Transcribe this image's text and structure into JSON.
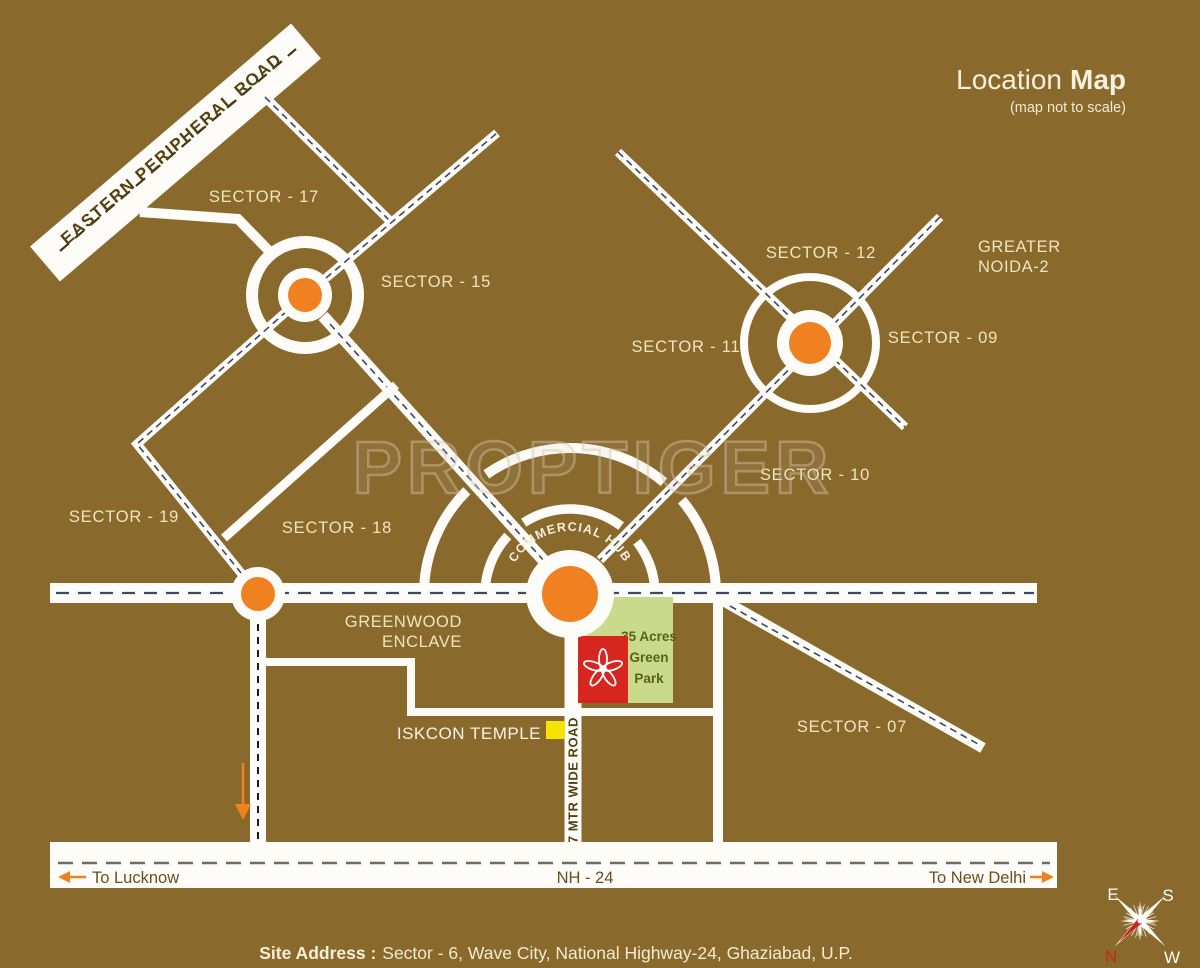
{
  "title": {
    "main": "Location",
    "main_bold": "Map",
    "subtitle": "(map not to scale)"
  },
  "watermark": "PROPTIGER",
  "labels": {
    "sector_17": "SECTOR - 17",
    "sector_15": "SECTOR - 15",
    "sector_12": "SECTOR - 12",
    "sector_11": "SECTOR - 11",
    "sector_09": "SECTOR - 09",
    "sector_10": "SECTOR - 10",
    "sector_19": "SECTOR - 19",
    "sector_18": "SECTOR - 18",
    "sector_07": "SECTOR - 07",
    "greater_noida_line1": "GREATER",
    "greater_noida_line2": "NOIDA-2",
    "greenwood_line1": "GREENWOOD",
    "greenwood_line2": "ENCLAVE",
    "commercial_hub": "COMMERCIAL HUB",
    "iskcon_temple": "ISKCON TEMPLE",
    "green_park_line1": "35 Acres",
    "green_park_line2": "Green",
    "green_park_line3": "Park"
  },
  "roads": {
    "eastern_peripheral_road": "EASTERN PERIPHERAL ROAD",
    "wide_road": "57 MTR WIDE ROAD",
    "nh24": "NH - 24",
    "to_lucknow": "To Lucknow",
    "to_new_delhi": "To New Delhi"
  },
  "footer": {
    "site_address_label": "Site Address :",
    "site_address_text": "Sector - 6, Wave City, National Highway-24, Ghaziabad, U.P."
  },
  "compass": {
    "east": "E",
    "south": "S",
    "north": "N",
    "west": "W"
  },
  "colors": {
    "background": "#8a692d",
    "road_white": "#fdfcf8",
    "accent_orange": "#ef8120",
    "sector_text": "#f0e4bd",
    "dark_road_text": "#55400f",
    "red_marker": "#d6261f",
    "green_park": "#c9da8c",
    "green_park_text": "#5a611c",
    "yellow_marker": "#f6e300",
    "dash_navy": "#3b4a63",
    "compass_red": "#c8251c"
  }
}
